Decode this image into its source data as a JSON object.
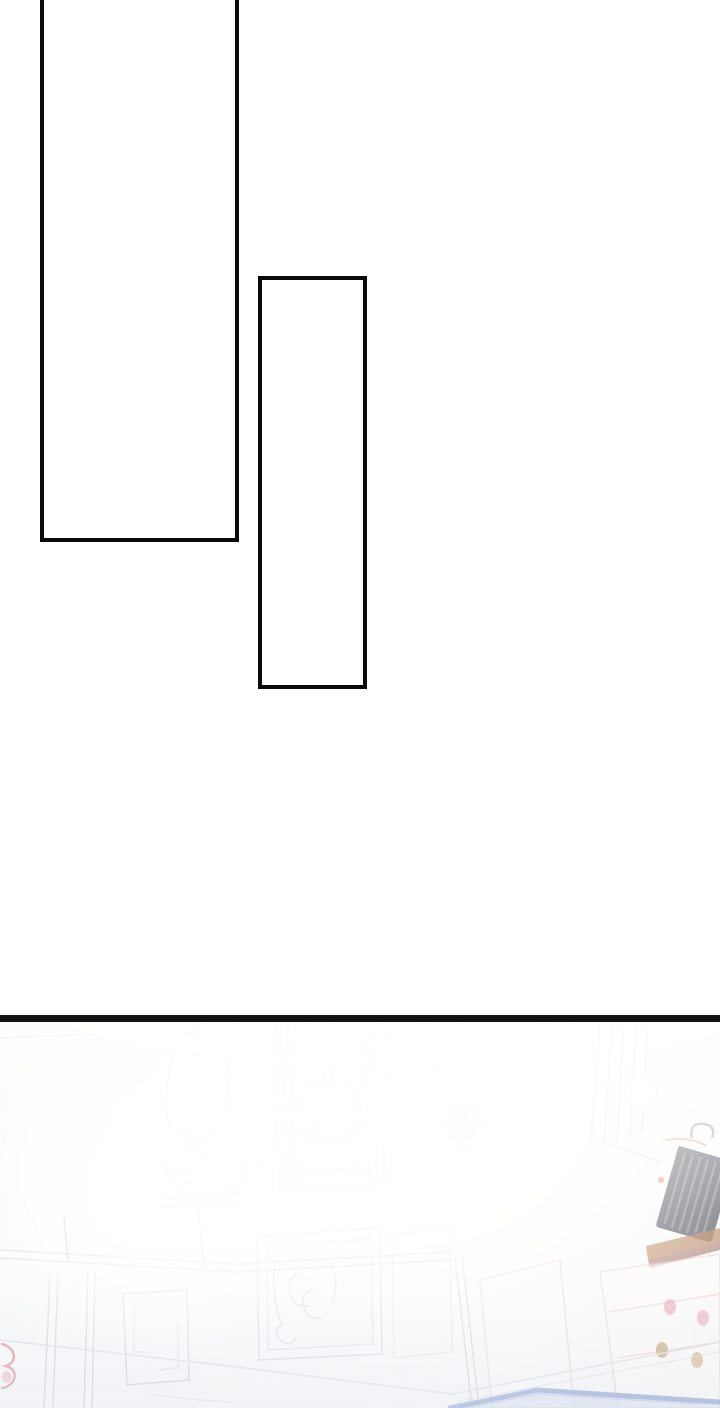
{
  "page": {
    "kind": "webtoon comic page",
    "background_color": "#ffffff"
  },
  "panels": [
    {
      "name": "empty-panel-top",
      "border_color": "#0a0a0a",
      "fill_color": "#ffffff",
      "note": "tall empty rectangle, top edge cropped off-screen"
    },
    {
      "name": "empty-panel-bottom",
      "border_color": "#0a0a0a",
      "fill_color": "#ffffff",
      "note": "narrow tall empty rectangle"
    }
  ],
  "divider": {
    "color": "#131313"
  },
  "scene": {
    "name": "sunlight-flooded ornate palace room, washed out by white glow",
    "colors": {
      "background": "#fcfcfb",
      "lineart_gray": "#cdd1d8",
      "rail_gray": "#d8dbe0",
      "flower_pink": "#e8b0b0",
      "accent_red": "#dc9aa0",
      "books_dark": "#55555f",
      "books_stripe": "#8f8f99",
      "shelf_brown": "#b07c50",
      "shelf_dark_red": "#8f4c40",
      "cabinet_outline_pink": "#e8caca",
      "knob_pink": "#e9aab6",
      "knob_gold": "#c9a878",
      "carpet_border_blue": "#8ca1d1",
      "carpet_fill_blue": "#ccd8ec",
      "bokeh_white": "#ffffff",
      "orange_dot": "#d9884a"
    },
    "elements": [
      "wall-carving-ornament",
      "framed-pediment-crest",
      "pink-flower-cluster",
      "curtain-stripes",
      "light-bokeh-circles",
      "book-row",
      "wall-shelf",
      "side-cabinet-with-knobs",
      "wainscot-panels",
      "blue-carpet-corner",
      "left-edge-pink-flower"
    ]
  }
}
